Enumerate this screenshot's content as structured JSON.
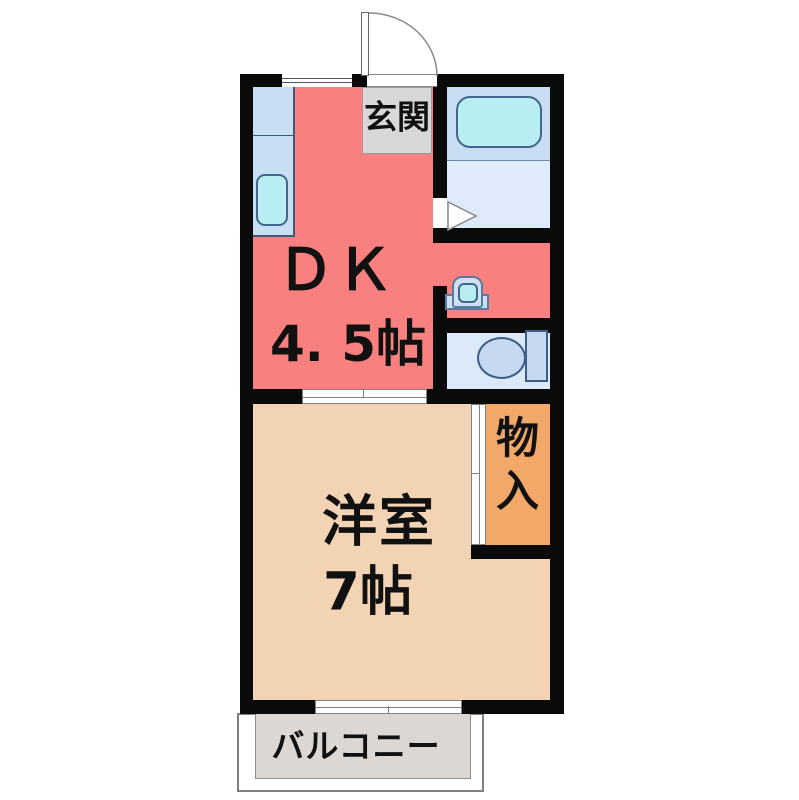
{
  "floorplan": {
    "title": "1DK apartment floor plan",
    "rooms": {
      "dk": {
        "name": "ＤＫ",
        "size": "4. 5帖",
        "color": "#f8807f"
      },
      "western": {
        "name": "洋室",
        "size": "7帖",
        "color": "#f2d3b4"
      },
      "closet": {
        "name": "物入",
        "color": "#f2a869"
      },
      "genkan": {
        "name": "玄関",
        "color": "#d8d8d8"
      },
      "balcony": {
        "name": "バルコニー",
        "color": "#dcd7d2"
      },
      "bathroom": {
        "color_upper": "#c8dcf2",
        "color_lower": "#dfeafb"
      },
      "toilet_room": {
        "color": "#dbe9f9"
      }
    },
    "fixture_icons": [
      "bathtub-icon",
      "toilet-icon",
      "wash-basin-icon",
      "kitchen-sink-icon",
      "entrance-door-icon",
      "door-swing-icon",
      "window-icon",
      "sliding-door-icon"
    ],
    "colors": {
      "wall": "#0a0a0a",
      "fixture_fill": "#b8eef2",
      "fixture_border": "#41678a",
      "toilet_fill": "#c7d9f0",
      "text": "#111111"
    }
  }
}
